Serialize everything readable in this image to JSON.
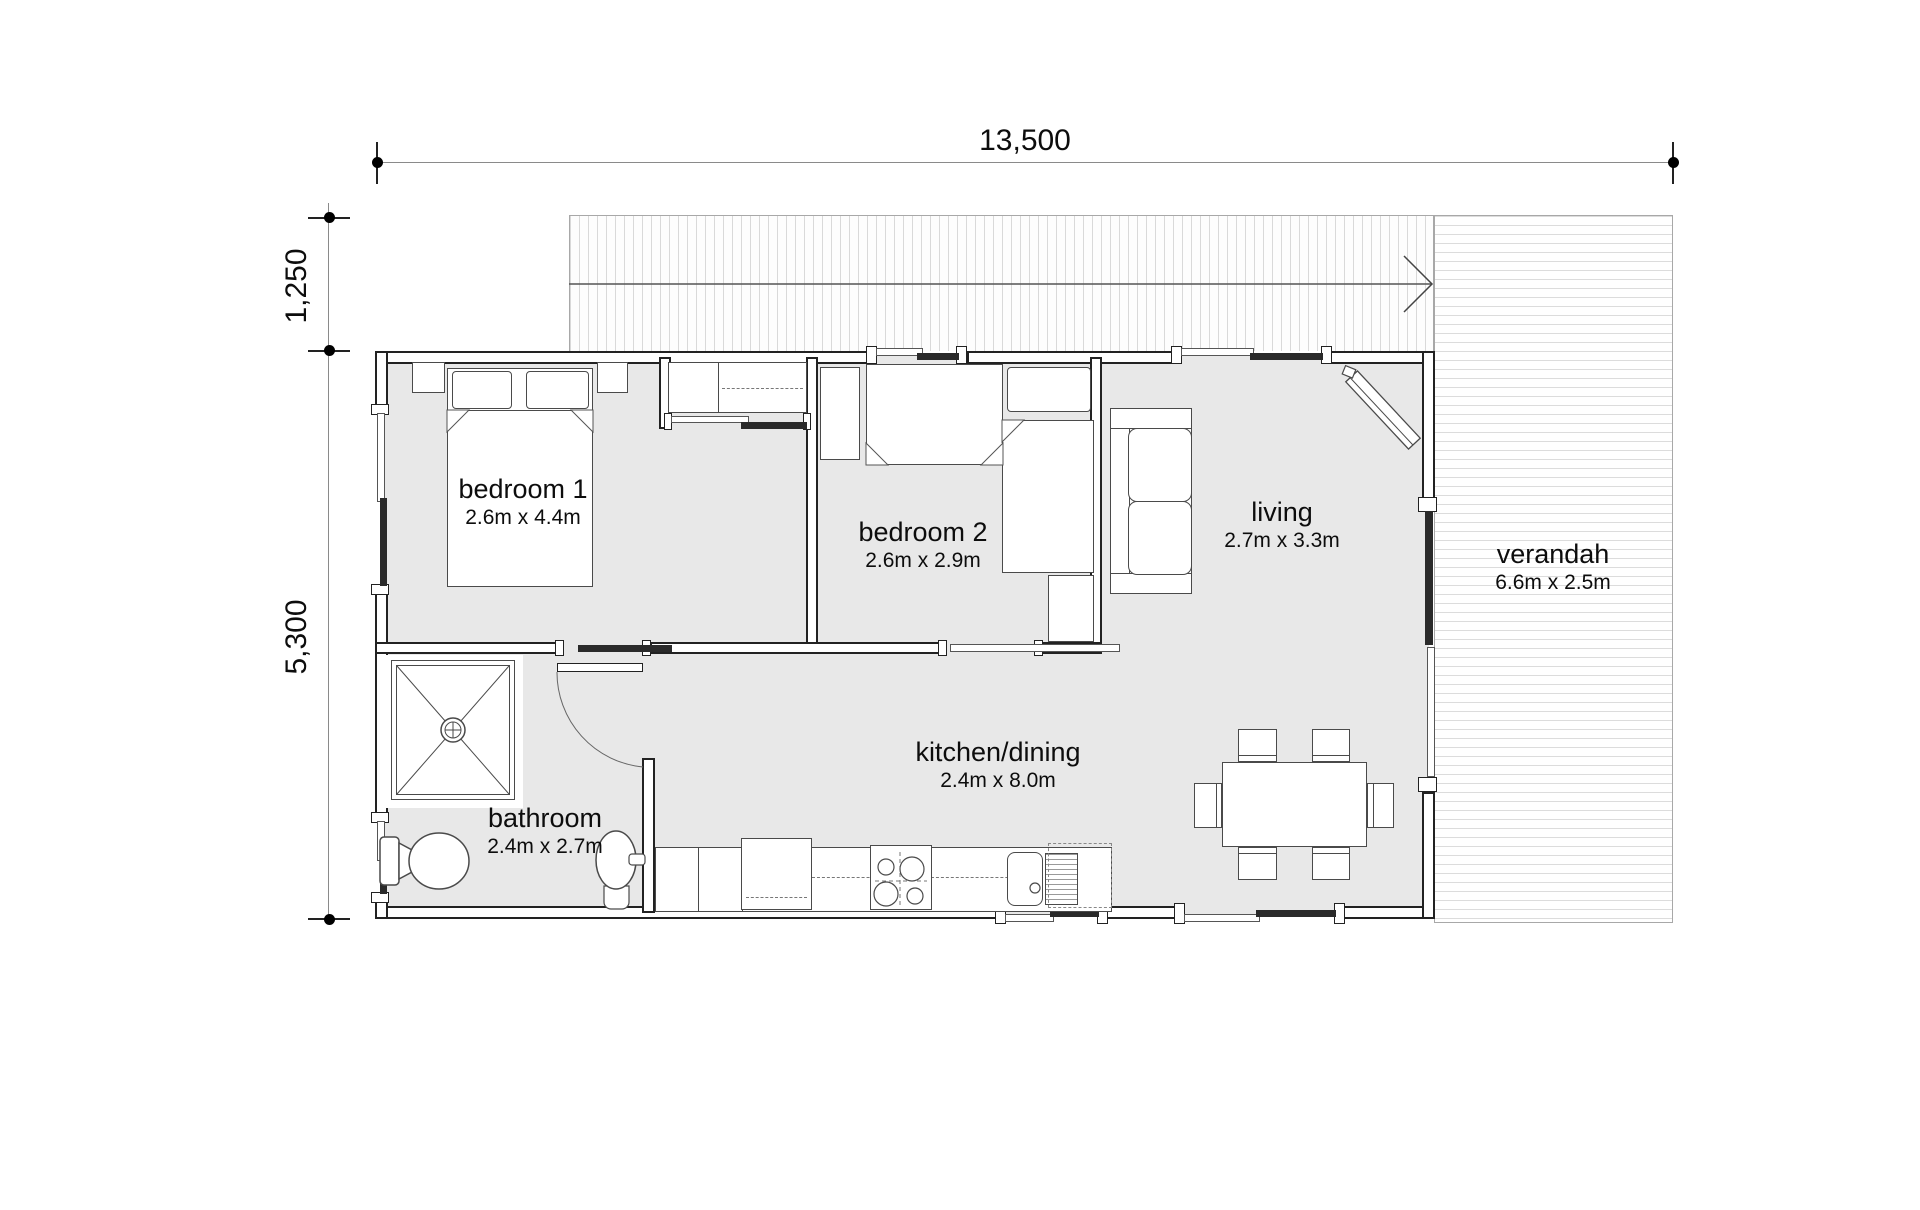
{
  "drawing": {
    "dim_width": "13,500",
    "dim_offset": "1,250",
    "dim_depth": "5,300"
  },
  "rooms": [
    {
      "name": "bedroom 1",
      "size": "2.6m x 4.4m"
    },
    {
      "name": "bedroom 2",
      "size": "2.6m x 2.9m"
    },
    {
      "name": "living",
      "size": "2.7m x 3.3m"
    },
    {
      "name": "kitchen/dining",
      "size": "2.4m x 8.0m"
    },
    {
      "name": "bathroom",
      "size": "2.4m x 2.7m"
    },
    {
      "name": "verandah",
      "size": "6.6m x 2.5m"
    }
  ],
  "colors": {
    "floor": "#e8e8e8",
    "wall": "#222222",
    "hatch": "#d9d9d9",
    "dim_line": "#8a8a8a",
    "text": "#0d0d0d"
  }
}
